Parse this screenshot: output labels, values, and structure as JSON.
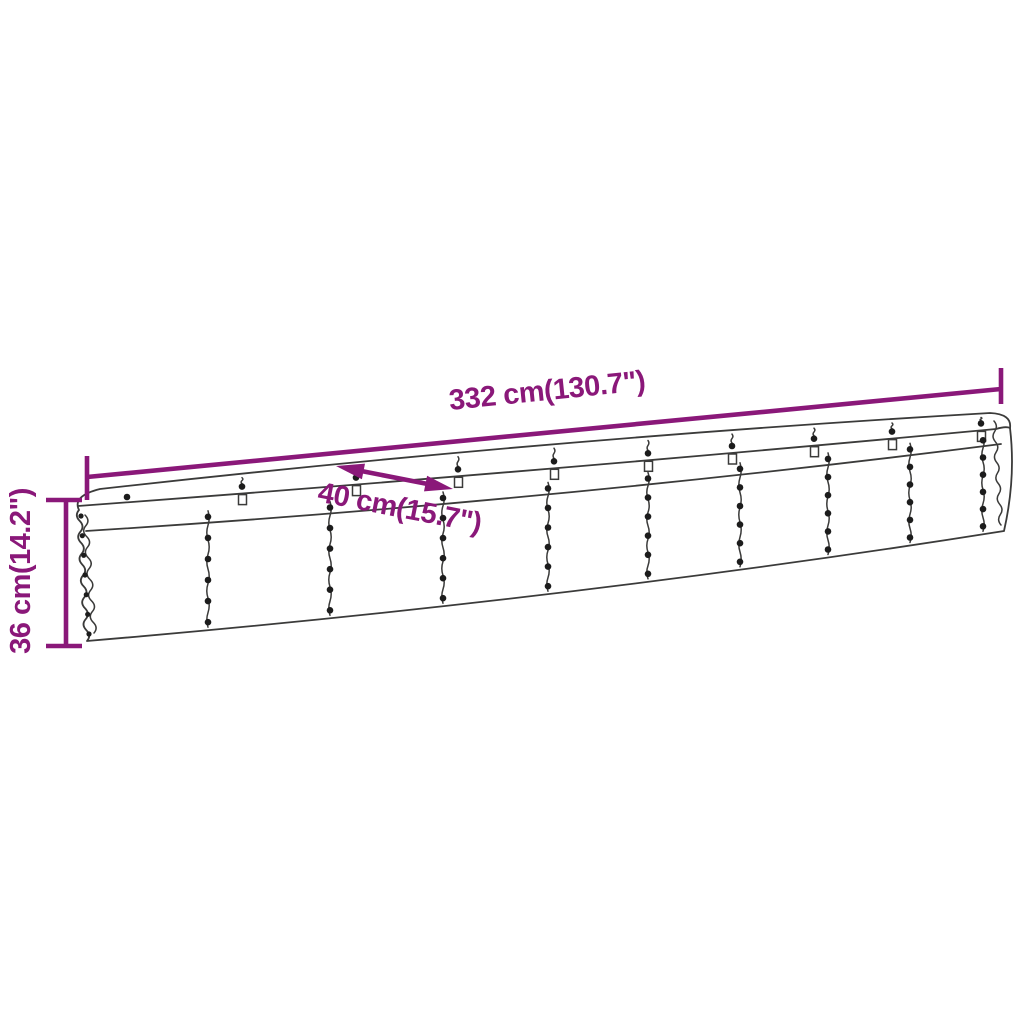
{
  "diagram": {
    "type": "product-dimension-diagram",
    "subject": "corrugated steel raised garden bed (long oval planter)",
    "dimensions": {
      "length": "332 cm(130.7\")",
      "width": "40 cm(15.7\")",
      "height": "36 cm(14.2\")"
    },
    "colors": {
      "accent": "#8A1879",
      "line": "#3B3B3A",
      "rivet": "#1C1C1C",
      "background": "#FFFFFF"
    }
  }
}
